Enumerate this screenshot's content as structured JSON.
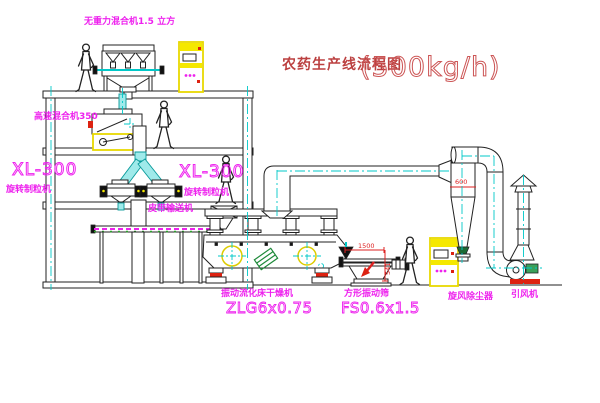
{
  "title": {
    "main": "农药生产线流程图",
    "capacity": "(500kg/h)"
  },
  "equipment": {
    "gravity_mixer": {
      "label": "无重力混合机1.5 立方"
    },
    "high_speed_mixer": {
      "label": "高速混合机350"
    },
    "granulator_left": {
      "model": "XL-300",
      "label": "旋转制粒机"
    },
    "granulator_right": {
      "model": "XL-300",
      "label": "旋转制粒机"
    },
    "belt_conveyor": {
      "label": "皮带输送机"
    },
    "fluid_bed_dryer": {
      "label": "振动流化床干燥机",
      "model": "ZLG6x0.75"
    },
    "vibrating_screen": {
      "label": "方形振动筛",
      "model": "FS0.6x1.5"
    },
    "cyclone": {
      "label": "旋风除尘器"
    },
    "induced_draft_fan": {
      "label": "引风机"
    }
  },
  "dimensions": {
    "screen_length": "1500",
    "screen_height": "541",
    "cyclone_diameter": "600"
  },
  "colors": {
    "line": "#222222",
    "centerline_cyan": "#00c8c8",
    "pipe_fill": "#9feaea",
    "label_magenta": "#ee22ee",
    "highlight_yellow": "#f5e800",
    "dimension_red": "#dd2222",
    "title_red": "#bb4040",
    "motor_green": "#3aa05a",
    "base_red": "#dd2211"
  }
}
